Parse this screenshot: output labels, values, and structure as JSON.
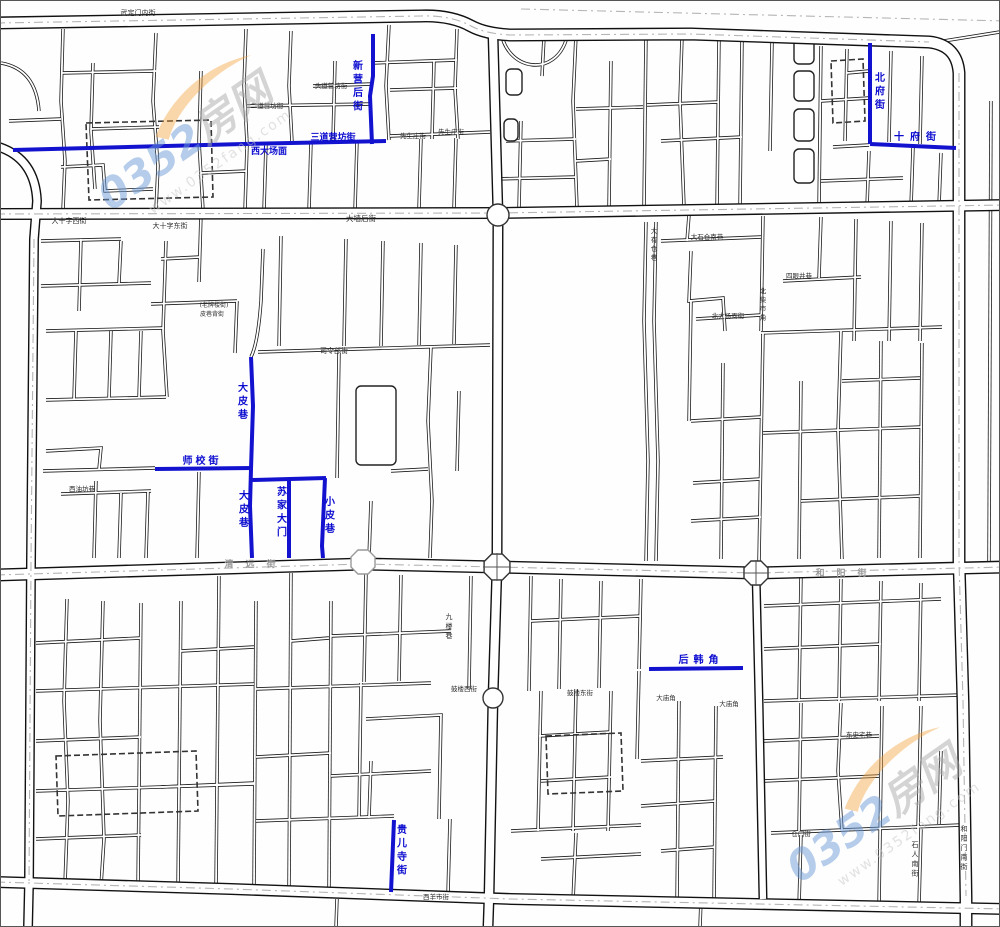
{
  "watermark": {
    "brand_prefix": "0352",
    "brand_suffix": "房网",
    "url": "www.0352fang.com"
  },
  "colors": {
    "highlight": "#1212cf",
    "road_line": "#1a1a1a",
    "label_dark": "#2e2e2e",
    "label_gray": "#9a9a9a",
    "watermark_blue": "#6f9bd8",
    "watermark_gray": "#ababab",
    "watermark_orange": "#f2a23c"
  },
  "map": {
    "labels": [
      {
        "text": "新营后街",
        "x": 357,
        "y": 68,
        "o": "v",
        "c": "blue",
        "s": 10
      },
      {
        "text": "三道营坊街",
        "x": 332,
        "y": 139,
        "o": "h",
        "c": "blue",
        "s": 9
      },
      {
        "text": "西大场面",
        "x": 268,
        "y": 153,
        "o": "h",
        "c": "blue",
        "s": 9
      },
      {
        "text": "北府街",
        "x": 879,
        "y": 80,
        "o": "v",
        "c": "blue",
        "s": 10
      },
      {
        "text": "十府街",
        "x": 917,
        "y": 139,
        "o": "h",
        "c": "blue",
        "s": 10,
        "sp": 6
      },
      {
        "text": "大皮巷",
        "x": 242,
        "y": 390,
        "o": "v",
        "c": "blue",
        "s": 10
      },
      {
        "text": "师校街",
        "x": 201,
        "y": 463,
        "o": "h",
        "c": "blue",
        "s": 10,
        "sp": 3
      },
      {
        "text": "大皮巷",
        "x": 243,
        "y": 498,
        "o": "v",
        "c": "blue",
        "s": 10
      },
      {
        "text": "苏家大门",
        "x": 281,
        "y": 494,
        "o": "v",
        "c": "blue",
        "s": 10
      },
      {
        "text": "小皮巷",
        "x": 329,
        "y": 504,
        "o": "v",
        "c": "blue",
        "s": 10
      },
      {
        "text": "后韩角",
        "x": 700,
        "y": 662,
        "o": "h",
        "c": "blue",
        "s": 10,
        "sp": 5
      },
      {
        "text": "贵儿寺街",
        "x": 401,
        "y": 832,
        "o": "v",
        "c": "blue",
        "s": 10
      },
      {
        "text": "武定门内街",
        "x": 137,
        "y": 14,
        "o": "h",
        "c": "dark",
        "s": 7
      },
      {
        "text": "大十字西街",
        "x": 68,
        "y": 222,
        "o": "h",
        "c": "dark",
        "s": 7
      },
      {
        "text": "大十字东街",
        "x": 169,
        "y": 227,
        "o": "h",
        "c": "dark",
        "s": 7
      },
      {
        "text": "大墙后街",
        "x": 360,
        "y": 220,
        "o": "h",
        "c": "dark",
        "s": 7.5
      },
      {
        "text": "头道营坊街",
        "x": 330,
        "y": 87,
        "o": "h",
        "c": "dark",
        "s": 6.5
      },
      {
        "text": "二道营坊街",
        "x": 266,
        "y": 107,
        "o": "h",
        "c": "dark",
        "s": 6.5
      },
      {
        "text": "先生庄街",
        "x": 412,
        "y": 137,
        "o": "h",
        "c": "dark",
        "s": 6.5
      },
      {
        "text": "先生庄街",
        "x": 450,
        "y": 133,
        "o": "h",
        "c": "dark",
        "s": 6.5
      },
      {
        "text": "司令部街",
        "x": 333,
        "y": 352,
        "o": "h",
        "c": "dark",
        "s": 7
      },
      {
        "text": "(老牌楼街)",
        "x": 213,
        "y": 306,
        "o": "h",
        "c": "dark",
        "s": 6
      },
      {
        "text": "皮巷背街",
        "x": 211,
        "y": 315,
        "o": "h",
        "c": "dark",
        "s": 6
      },
      {
        "text": "西油坊巷",
        "x": 81,
        "y": 490,
        "o": "h",
        "c": "dark",
        "s": 6.5
      },
      {
        "text": "九楼巷",
        "x": 448,
        "y": 618,
        "o": "v",
        "c": "dark",
        "s": 7
      },
      {
        "text": "鼓楼西街",
        "x": 463,
        "y": 690,
        "o": "h",
        "c": "dark",
        "s": 6.5
      },
      {
        "text": "鼓楼东街",
        "x": 579,
        "y": 694,
        "o": "h",
        "c": "dark",
        "s": 6.5
      },
      {
        "text": "大庙角",
        "x": 665,
        "y": 699,
        "o": "h",
        "c": "dark",
        "s": 6.5
      },
      {
        "text": "大庙角",
        "x": 728,
        "y": 705,
        "o": "h",
        "c": "dark",
        "s": 6.5
      },
      {
        "text": "大有仓巷",
        "x": 653,
        "y": 232,
        "o": "v",
        "c": "dark",
        "s": 6.5
      },
      {
        "text": "大石仓南巷",
        "x": 706,
        "y": 238,
        "o": "h",
        "c": "dark",
        "s": 6.5
      },
      {
        "text": "四眼井巷",
        "x": 798,
        "y": 277,
        "o": "h",
        "c": "dark",
        "s": 6.5
      },
      {
        "text": "北柴市角",
        "x": 762,
        "y": 292,
        "o": "v",
        "c": "dark",
        "s": 6.5
      },
      {
        "text": "北大场面街",
        "x": 727,
        "y": 317,
        "o": "h",
        "c": "dark",
        "s": 6.5
      },
      {
        "text": "东史宅巷",
        "x": 858,
        "y": 736,
        "o": "h",
        "c": "dark",
        "s": 6.5
      },
      {
        "text": "石人南街",
        "x": 914,
        "y": 846,
        "o": "v",
        "c": "dark",
        "s": 7
      },
      {
        "text": "和阳门南街",
        "x": 963,
        "y": 830,
        "o": "v",
        "c": "dark",
        "s": 7
      },
      {
        "text": "仓门街",
        "x": 800,
        "y": 835,
        "o": "h",
        "c": "dark",
        "s": 6.5
      },
      {
        "text": "西羊市街",
        "x": 435,
        "y": 898,
        "o": "h",
        "c": "dark",
        "s": 6.5
      },
      {
        "text": "清远街",
        "x": 255,
        "y": 566,
        "o": "h",
        "c": "gray",
        "s": 9,
        "sp": 12
      },
      {
        "text": "和阳街",
        "x": 846,
        "y": 575,
        "o": "h",
        "c": "gray",
        "s": 9,
        "sp": 12
      }
    ]
  }
}
